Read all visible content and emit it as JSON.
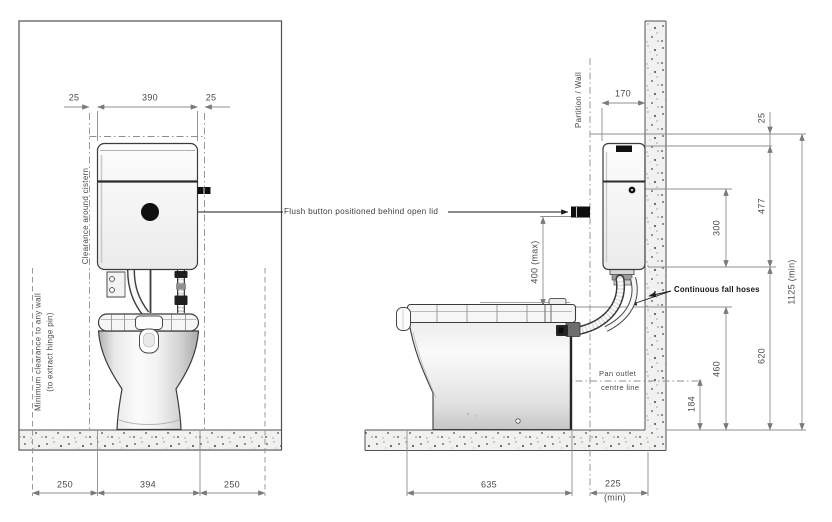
{
  "front_view": {
    "top_dims": {
      "left": "25",
      "mid": "390",
      "right": "25"
    },
    "bottom_dims": {
      "left": "250",
      "mid": "394",
      "right": "250"
    },
    "clearance_cistern": "Clearance around cistern",
    "min_clearance_line1": "Minimum clearance to any wall",
    "min_clearance_line2": "(to extract hinge pin)"
  },
  "side_view": {
    "partition_label": "Partition / Wall",
    "hoses_label": "Continuous fall hoses",
    "pan_outlet_line1": "Pan outlet",
    "pan_outlet_line2": "centre line",
    "dims": {
      "wall_offset": "170",
      "lid_clearance": "25",
      "cistern_height": "477",
      "button_height": "300",
      "overall_height": "1125 (min)",
      "hose_height": "620",
      "seat_height": "460",
      "outlet_height": "184",
      "pan_depth": "635",
      "partition_gap": "225",
      "partition_gap_note": "(min)",
      "button_max": "400 (max)"
    }
  },
  "annotations": {
    "flush_button_note": "Flush button positioned behind open lid"
  },
  "colors": {
    "object_line": "#3c3c3c",
    "dimension_line": "#8f8f8f",
    "accent_black": "#101010",
    "floor_fill": "#f1f1ef"
  }
}
